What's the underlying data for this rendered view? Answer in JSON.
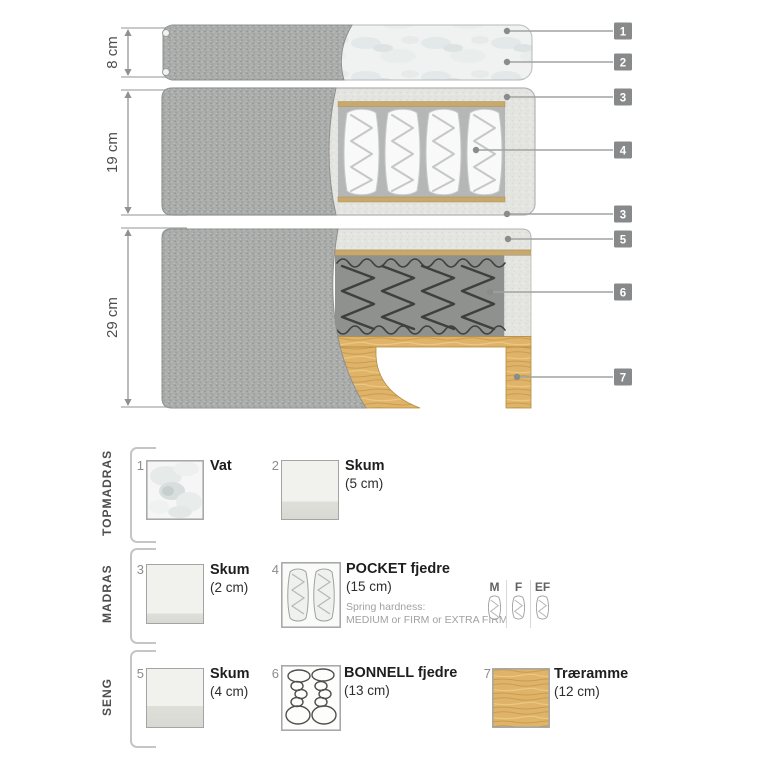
{
  "diagram": {
    "dimensions": [
      {
        "label": "8 cm"
      },
      {
        "label": "19 cm"
      },
      {
        "label": "29 cm"
      }
    ],
    "callouts": [
      {
        "label": "1"
      },
      {
        "label": "2"
      },
      {
        "label": "3"
      },
      {
        "label": "4"
      },
      {
        "label": "3"
      },
      {
        "label": "5"
      },
      {
        "label": "6"
      },
      {
        "label": "7"
      }
    ]
  },
  "legend": {
    "groups": [
      {
        "label": "TOPMADRAS",
        "items": [
          {
            "num": "1",
            "title": "Vat",
            "icon": "vat-swatch"
          },
          {
            "num": "2",
            "title": "Skum",
            "size": "(5 cm)",
            "icon": "foam-swatch"
          }
        ]
      },
      {
        "label": "MADRAS",
        "items": [
          {
            "num": "3",
            "title": "Skum",
            "size": "(2 cm)",
            "icon": "foam-swatch"
          },
          {
            "num": "4",
            "title": "POCKET fjedre",
            "size": "(15 cm)",
            "icon": "pocket-springs-icon",
            "note_line1": "Spring hardness:",
            "note_line2": "MEDIUM or FIRM or EXTRA FIRM"
          }
        ],
        "hardness_options": [
          {
            "label": "M"
          },
          {
            "label": "F"
          },
          {
            "label": "EF"
          }
        ]
      },
      {
        "label": "SENG",
        "items": [
          {
            "num": "5",
            "title": "Skum",
            "size": "(4 cm)",
            "icon": "foam-swatch"
          },
          {
            "num": "6",
            "title": "BONNELL fjedre",
            "size": "(13 cm)",
            "icon": "bonnell-springs-icon"
          },
          {
            "num": "7",
            "title": "Træramme",
            "size": "(12 cm)",
            "icon": "wood-swatch"
          }
        ]
      }
    ]
  },
  "colors": {
    "badge_gray": "#87898a",
    "fabric_gray": "#a9acaa",
    "foam_light": "#e4e5e1",
    "wood": "#dfb369",
    "bonnell_background": "#8f918f",
    "tan_layer": "#c9a86b",
    "callout_line": "#a0a3a1"
  }
}
